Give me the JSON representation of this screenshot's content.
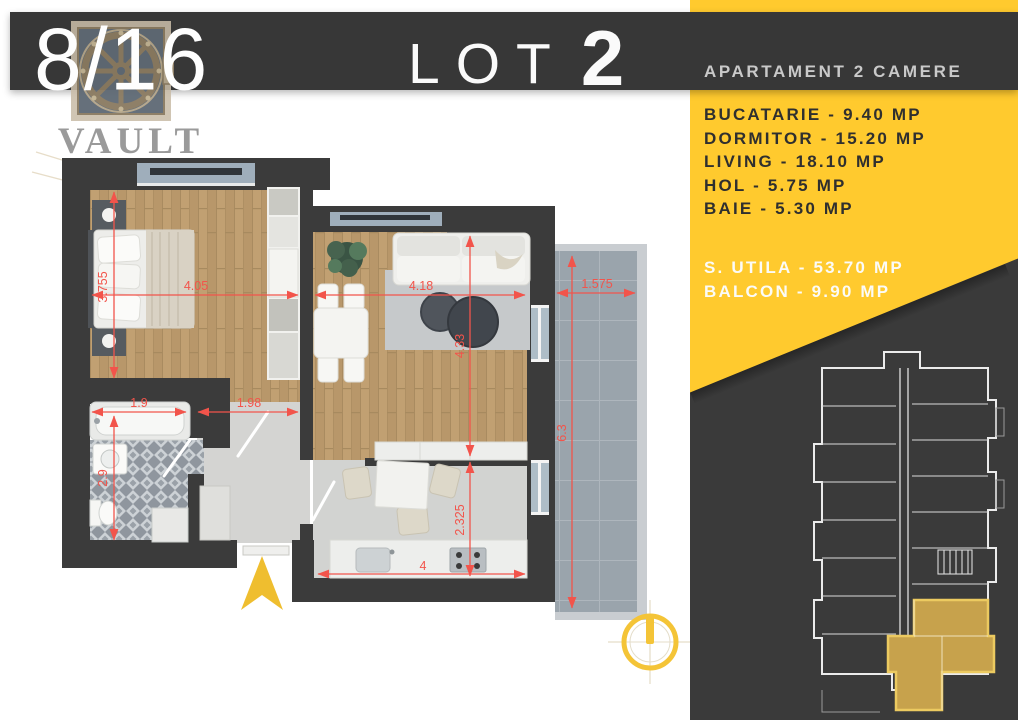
{
  "header": {
    "unit_number": "8/16",
    "lot_word": "LOT",
    "lot_number": "2",
    "subtitle": "APARTAMENT 2 CAMERE"
  },
  "brand": {
    "name": "VAULT",
    "tagline": "ESTATE"
  },
  "areas": {
    "rooms": [
      "BUCATARIE - 9.40 MP",
      "DORMITOR - 15.20 MP",
      "LIVING - 18.10 MP",
      "HOL - 5.75 MP",
      "BAIE - 5.30 MP"
    ],
    "totals": [
      "S. UTILA - 53.70 MP",
      "BALCON - 9.90 MP"
    ]
  },
  "floorplan": {
    "dims": {
      "bedroom_h": "3.755",
      "bedroom_w": "4.05",
      "living_w": "4.18",
      "living_h": "4.33",
      "balcony_w": "1.575",
      "balcony_h": "6.3",
      "bath_w": "1.9",
      "bath_h": "2.9",
      "hall_w": "1.98",
      "kitchen_h": "2.325",
      "kitchen_w": "4"
    }
  },
  "colors": {
    "accent_yellow": "#FFCA2E",
    "panel_dark": "#3A3A3A",
    "wall_dark": "#3B3B3B",
    "dimension_red": "#F2544B",
    "highlight_gold": "#C7A24C",
    "wood_floor": "#C1A072",
    "balcony_tile": "#9AA4AC"
  }
}
